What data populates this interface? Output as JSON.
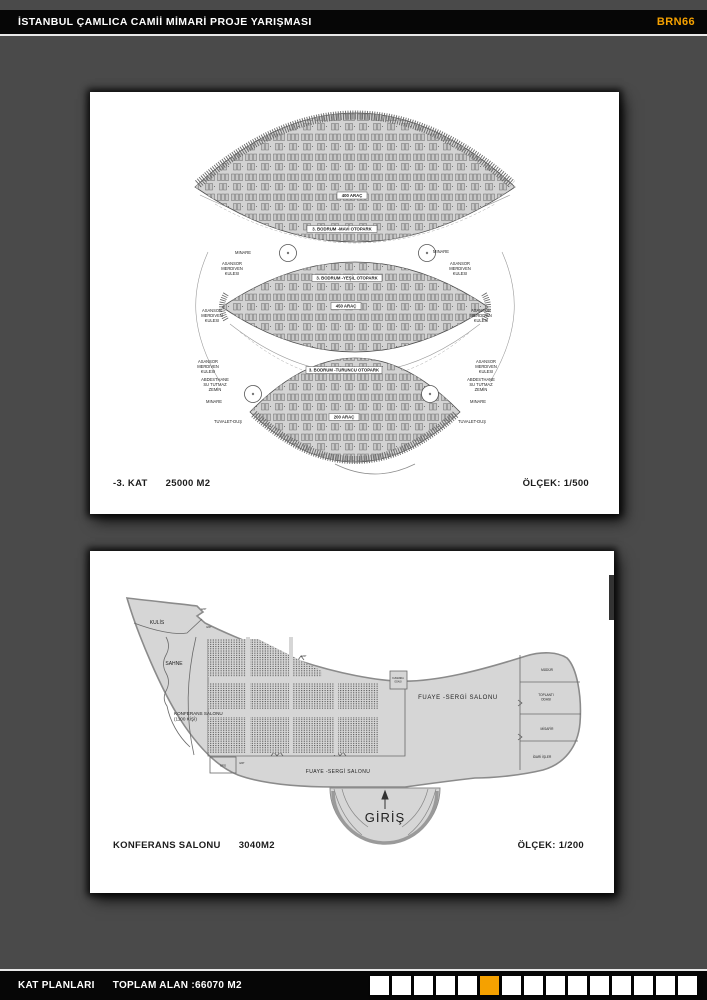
{
  "header": {
    "title": "İSTANBUL ÇAMLICA CAMİİ MİMARİ PROJE YARIŞMASI",
    "code": "BRN66",
    "accent_color": "#F5A100"
  },
  "panel1": {
    "caption": {
      "floor": "-3. KAT",
      "area": "25000 M2",
      "scale": "ÖLÇEK: 1/500"
    },
    "zones": {
      "mavi": {
        "name": "3. BODRUM -MAVİ OTOPARK",
        "cars": "400 ARAÇ"
      },
      "yesil": {
        "name": "3. BODRUM -YEŞİL OTOPARK",
        "cars": "450 ARAÇ"
      },
      "turuncu": {
        "name": "3. BODRUM -TURUNCU OTOPARK",
        "cars": "200 ARAÇ"
      }
    },
    "labels": {
      "minare": "MINARE",
      "tower": [
        "ASANSOR",
        "MERDIVEN",
        "KULESI"
      ],
      "abdesthane": [
        "ABDESTHANE",
        "SU TUTMAZ",
        "ZEMİN"
      ],
      "tuvalet": "TUVALET-DUŞ"
    }
  },
  "panel2": {
    "caption": {
      "name": "KONFERANS SALONU",
      "area": "3040M2",
      "scale": "ÖLÇEK: 1/200"
    },
    "rooms": {
      "kulis": "KULİS",
      "sahne": "SAHNE",
      "konferans": [
        "KONFERANS SALONU",
        "(1100 KİŞİ)"
      ],
      "fuaye": "FUAYE -SERGİ SALONU",
      "mudur": "MÜDÜR",
      "toplanti": [
        "TOPLANTI",
        "ODASI"
      ],
      "misafir": "MİSAFİR",
      "idari": "İDARİ İŞLER",
      "giris": "GİRİŞ",
      "kumanda": [
        "KUMANDA",
        "ODASI"
      ],
      "ofis": "OFİS",
      "exit": "EXIT"
    }
  },
  "footer": {
    "left": "KAT PLANLARI",
    "total": "TOPLAM ALAN :66070 M2",
    "squares": {
      "count": 15,
      "active_index": 6,
      "active_color": "#F5A100",
      "inactive_color": "#ffffff"
    }
  }
}
